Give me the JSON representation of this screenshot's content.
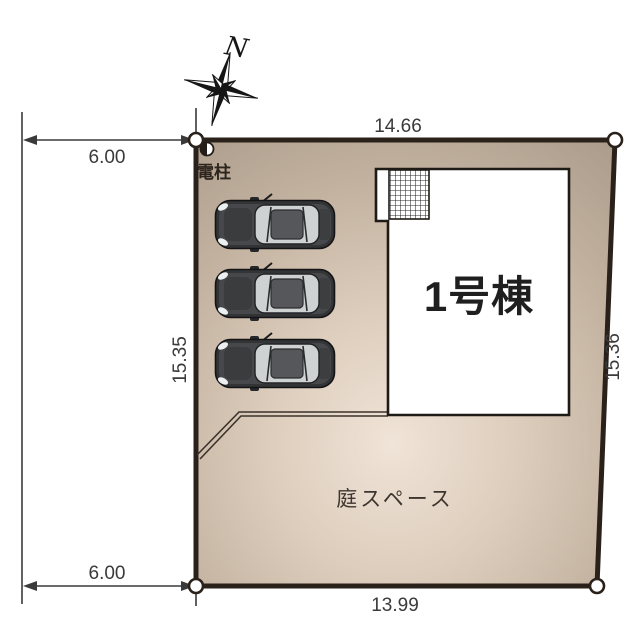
{
  "compass": {
    "north_label": "N"
  },
  "dimensions": {
    "top_offset": "6.00",
    "top_width": "14.66",
    "left_depth": "15.35",
    "right_depth": "15.36",
    "bottom_width": "13.99",
    "bottom_offset": "6.00"
  },
  "plot": {
    "border_color": "#2a211a",
    "fill_center": "#f0e4d8",
    "fill_mid": "#d4c4b2",
    "fill_edge": "#b0a08f",
    "garden_label": "庭スペース"
  },
  "building": {
    "label": "1号棟",
    "fill": "#ffffff",
    "outline_color": "#1e1a16"
  },
  "utility_pole": {
    "label": "電柱"
  },
  "parking": {
    "car_count": 3,
    "car_body_color": "#323436",
    "car_glass_color": "#cfd2d3"
  }
}
